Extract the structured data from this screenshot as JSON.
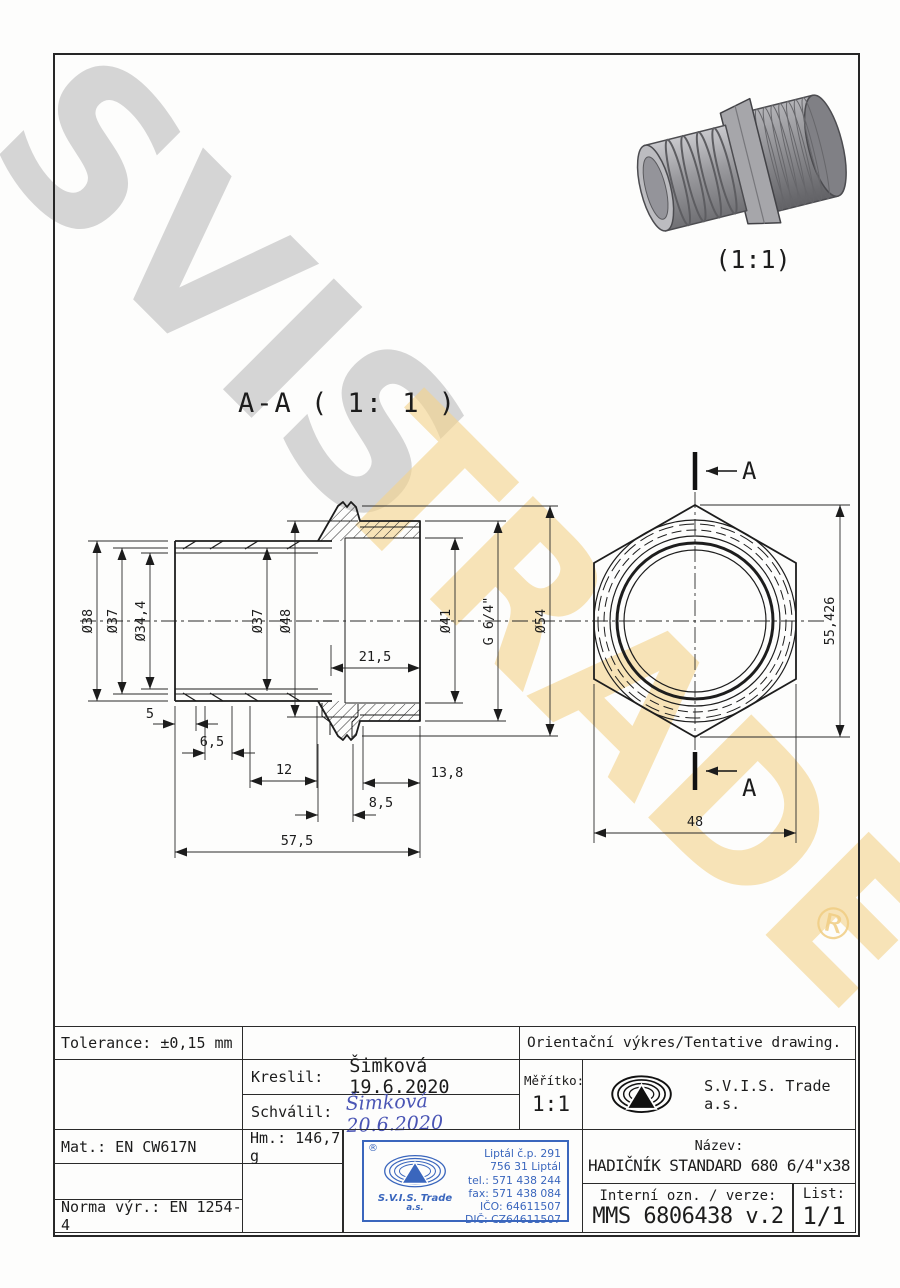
{
  "watermarks": {
    "svis": "SVIS",
    "trade": "TRADE",
    "registered": "®",
    "gray": "#cbcbcb",
    "yellow": "#f3d38c"
  },
  "pictorial": {
    "scale": "(1:1)"
  },
  "drawing": {
    "section_title": "A-A ( 1: 1 )",
    "side": {
      "d38": "Ø38",
      "d37": "Ø37",
      "d344": "Ø34,4",
      "d37i": "Ø37",
      "d48": "Ø48",
      "d41": "Ø41",
      "g": "G 6/4\"",
      "d54": "Ø54",
      "l5": "5",
      "l65": "6,5",
      "l12": "12",
      "l215": "21,5",
      "l138": "13,8",
      "l85": "8,5",
      "l575": "57,5"
    },
    "hex": {
      "mark": "A",
      "h": "55,426",
      "w": "48"
    }
  },
  "title_block": {
    "tolerance": "Tolerance: ±0,15 mm",
    "orientacni": "Orientační výkres/Tentative drawing.",
    "kreslil_label": "Kreslil:",
    "kreslil_value": "Šimková 19.6.2020",
    "schvalil_label": "Schválil:",
    "schvalil_value": "Šimková 20.6.2020",
    "meritko_label": "Měřítko:",
    "meritko_value": "1:1",
    "company": "S.V.I.S. Trade a.s.",
    "mat": "Mat.: EN CW617N",
    "hm": "Hm.: 146,7 g",
    "norma": "Norma výr.: EN 1254-4",
    "nazev_label": "Název:",
    "nazev_value": "HADIČNÍK STANDARD 680 6/4\"x38",
    "interni_label": "Interní ozn. / verze:",
    "interni_value": "MMS 6806438 v.2",
    "list_label": "List:",
    "list_value": "1/1"
  },
  "stamp": {
    "registered": "®",
    "company_line1": "S.V.I.S. Trade",
    "company_line2": "a.s.",
    "address1": "Liptál č.p. 291",
    "address2": "756 31 Liptál",
    "tel": "tel.: 571 438 244",
    "fax": "fax: 571 438 084",
    "ico": "IČO: 64611507",
    "dic": "DIČ: CZ64611507",
    "color": "#3a66bd"
  }
}
